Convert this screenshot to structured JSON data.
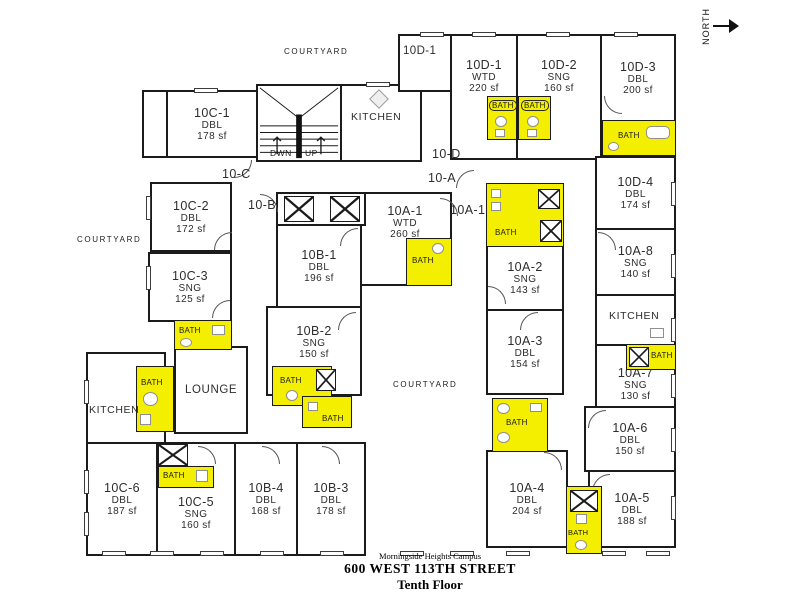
{
  "footer": {
    "campus": "Morningside Heights Campus",
    "address": "600 WEST 113TH STREET",
    "floor": "Tenth Floor"
  },
  "compass": "NORTH",
  "labels": {
    "bath": "BATH",
    "kitchen": "KITCHEN",
    "courtyard": "COURTYARD",
    "lounge": "LOUNGE",
    "down": "DWN",
    "up": "UP"
  },
  "corridors": {
    "c": "10-C",
    "b": "10-B",
    "d": "10-D",
    "a": "10-A",
    "a1": "10A-1",
    "d1": "10D-1"
  },
  "colors": {
    "bath_fill": "#f4ee00",
    "wall": "#1b1b1b"
  },
  "rooms": [
    {
      "id": "10C-1",
      "type": "DBL",
      "area": "178 sf"
    },
    {
      "id": "10C-2",
      "type": "DBL",
      "area": "172 sf"
    },
    {
      "id": "10C-3",
      "type": "SNG",
      "area": "125 sf"
    },
    {
      "id": "10C-5",
      "type": "SNG",
      "area": "160 sf"
    },
    {
      "id": "10C-6",
      "type": "DBL",
      "area": "187 sf"
    },
    {
      "id": "10B-1",
      "type": "DBL",
      "area": "196 sf"
    },
    {
      "id": "10B-2",
      "type": "SNG",
      "area": "150 sf"
    },
    {
      "id": "10B-3",
      "type": "DBL",
      "area": "178 sf"
    },
    {
      "id": "10B-4",
      "type": "DBL",
      "area": "168 sf"
    },
    {
      "id": "10A-1",
      "type": "WTD",
      "area": "260 sf"
    },
    {
      "id": "10A-2",
      "type": "SNG",
      "area": "143 sf"
    },
    {
      "id": "10A-3",
      "type": "DBL",
      "area": "154 sf"
    },
    {
      "id": "10A-4",
      "type": "DBL",
      "area": "204 sf"
    },
    {
      "id": "10A-5",
      "type": "DBL",
      "area": "188 sf"
    },
    {
      "id": "10A-6",
      "type": "DBL",
      "area": "150 sf"
    },
    {
      "id": "10A-7",
      "type": "SNG",
      "area": "130 sf"
    },
    {
      "id": "10A-8",
      "type": "SNG",
      "area": "140 sf"
    },
    {
      "id": "10D-1",
      "type": "WTD",
      "area": "220 sf"
    },
    {
      "id": "10D-2",
      "type": "SNG",
      "area": "160 sf"
    },
    {
      "id": "10D-3",
      "type": "DBL",
      "area": "200 sf"
    },
    {
      "id": "10D-4",
      "type": "DBL",
      "area": "174 sf"
    }
  ]
}
